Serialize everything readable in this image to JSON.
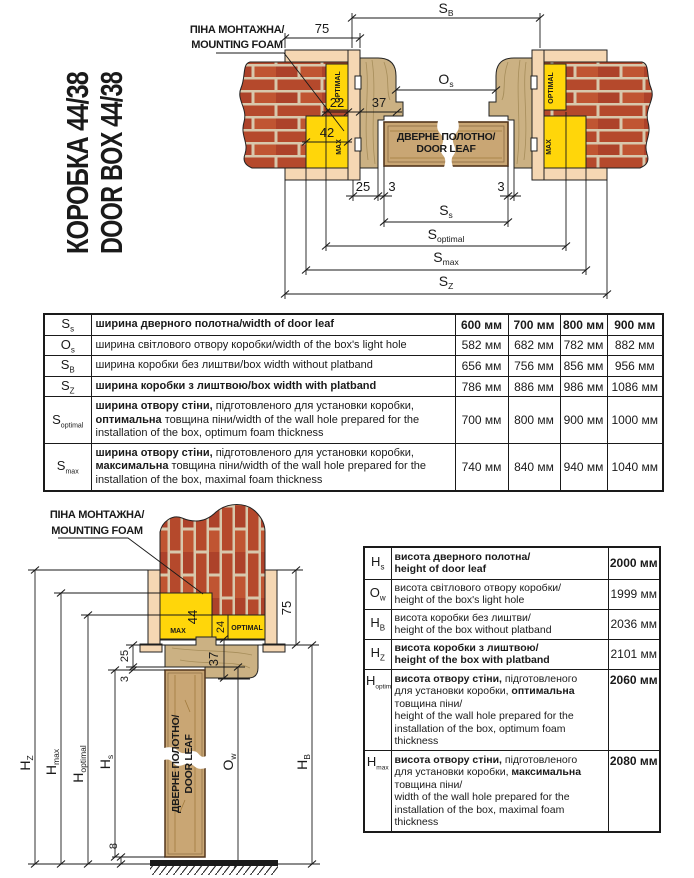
{
  "title": {
    "line1": "КОРОБКА 44/38",
    "line2": "DOOR BOX 44/38"
  },
  "colors": {
    "foam": "#ffd60a",
    "wood": "#cbb183",
    "leaf": "#c9a674",
    "platband": "#f5d7b3",
    "brick": "#b5492c",
    "mortar": "#d8c8ac",
    "ink": "#1a1a1a"
  },
  "labels": {
    "foam1": "ПІНА МОНТАЖНА/",
    "foam2": "MOUNTING FOAM",
    "leaf1": "ДВЕРНЕ ПОЛОТНО/",
    "leaf2": "DOOR LEAF",
    "optimal": "OPTIMAL",
    "max": "MAX"
  },
  "top": {
    "d75": "75",
    "d22": "22",
    "d37": "37",
    "d42": "42",
    "d25": "25",
    "d3l": "3",
    "d3r": "3",
    "sb_b": "S",
    "sb_s": "B",
    "os_b": "O",
    "os_s": "s",
    "ss_b": "S",
    "ss_s": "s",
    "sopt_b": "S",
    "sopt_s": "optimal",
    "smax_b": "S",
    "smax_s": "max",
    "sz_b": "S",
    "sz_s": "Z"
  },
  "bottom": {
    "d75": "75",
    "d44": "44",
    "d24": "24",
    "d37": "37",
    "d25": "25",
    "d3": "3",
    "d8": "8",
    "hz_b": "H",
    "hz_s": "Z",
    "hmax_b": "H",
    "hmax_s": "max",
    "hopt_b": "H",
    "hopt_s": "optimal",
    "hs_b": "H",
    "hs_s": "s",
    "ow_b": "O",
    "ow_s": "w",
    "hb_b": "H",
    "hb_s": "B"
  },
  "width_table": {
    "rows": [
      {
        "sym": "S",
        "sub": "s",
        "desc": [
          {
            "b": 1,
            "t": "ширина дверного полотна/width of door leaf"
          }
        ],
        "values": [
          "600 мм",
          "700 мм",
          "800 мм",
          "900 мм"
        ]
      },
      {
        "sym": "O",
        "sub": "s",
        "desc": [
          {
            "t": "ширина світлового отвору коробки/width of the box's light hole"
          }
        ],
        "values": [
          "582 мм",
          "682 мм",
          "782 мм",
          "882 мм"
        ]
      },
      {
        "sym": "S",
        "sub": "B",
        "desc": [
          {
            "t": "ширина коробки без лиштви/box width without platband"
          }
        ],
        "values": [
          "656 мм",
          "756 мм",
          "856 мм",
          "956 мм"
        ]
      },
      {
        "sym": "S",
        "sub": "Z",
        "desc": [
          {
            "b": 1,
            "t": "ширина коробки з лиштвою/box width with platband"
          }
        ],
        "values": [
          "786 мм",
          "886 мм",
          "986 мм",
          "1086 мм"
        ]
      },
      {
        "sym": "S",
        "sub": "optimal",
        "desc": [
          {
            "b": 1,
            "t": "ширина отвору стіни,"
          },
          {
            "t": " підготовленого для установки коробки, "
          },
          {
            "b": 1,
            "t": "оптимальна"
          },
          {
            "t": " товщина піни/width of the wall hole prepared for the installation of the box, optimum foam thickness"
          }
        ],
        "values": [
          "700 мм",
          "800 мм",
          "900 мм",
          "1000 мм"
        ]
      },
      {
        "sym": "S",
        "sub": "max",
        "desc": [
          {
            "b": 1,
            "t": "ширина отвору стіни,"
          },
          {
            "t": " підготовленого для установки коробки, "
          },
          {
            "b": 1,
            "t": "максимальна"
          },
          {
            "t": " товщина піни/width of the wall hole prepared for the installation of the box, maximal foam thickness"
          }
        ],
        "values": [
          "740 мм",
          "840 мм",
          "940 мм",
          "1040 мм"
        ]
      }
    ]
  },
  "height_table": {
    "rows": [
      {
        "sym": "H",
        "sub": "s",
        "desc": [
          {
            "b": 1,
            "t": "висота дверного полотна/"
          },
          {
            "br": 1
          },
          {
            "b": 1,
            "t": "height of door leaf"
          }
        ],
        "value": "2000 мм"
      },
      {
        "sym": "O",
        "sub": "w",
        "desc": [
          {
            "t": "висота світлового отвору коробки/"
          },
          {
            "br": 1
          },
          {
            "t": "height of the box's light hole"
          }
        ],
        "value": "1999 мм"
      },
      {
        "sym": "H",
        "sub": "B",
        "desc": [
          {
            "t": "висота коробки без лиштви/"
          },
          {
            "br": 1
          },
          {
            "t": "height of the box without platband"
          }
        ],
        "value": "2036 мм"
      },
      {
        "sym": "H",
        "sub": "Z",
        "desc": [
          {
            "b": 1,
            "t": "висота коробки з лиштвою/"
          },
          {
            "br": 1
          },
          {
            "b": 1,
            "t": "height of the box with platband"
          }
        ],
        "value": "2101 мм"
      },
      {
        "sym": "H",
        "sub": "optimal",
        "desc": [
          {
            "b": 1,
            "t": "висота отвору стіни,"
          },
          {
            "t": " підготовленого"
          },
          {
            "br": 1
          },
          {
            "t": "для установки коробки, "
          },
          {
            "b": 1,
            "t": "оптимальна"
          },
          {
            "br": 1
          },
          {
            "t": "товщина піни/"
          },
          {
            "br": 1
          },
          {
            "t": "height of the wall hole prepared for the installation of the box, optimum foam thickness"
          }
        ],
        "value": "2060 мм"
      },
      {
        "sym": "H",
        "sub": "max",
        "desc": [
          {
            "b": 1,
            "t": "висота отвору стіни,"
          },
          {
            "t": " підготовленого"
          },
          {
            "br": 1
          },
          {
            "t": "для установки коробки, "
          },
          {
            "b": 1,
            "t": "максимальна"
          },
          {
            "br": 1
          },
          {
            "t": "товщина піни/"
          },
          {
            "br": 1
          },
          {
            "t": "width of the wall hole prepared for the installation of the box, maximal foam thickness"
          }
        ],
        "value": "2080 мм"
      }
    ]
  }
}
